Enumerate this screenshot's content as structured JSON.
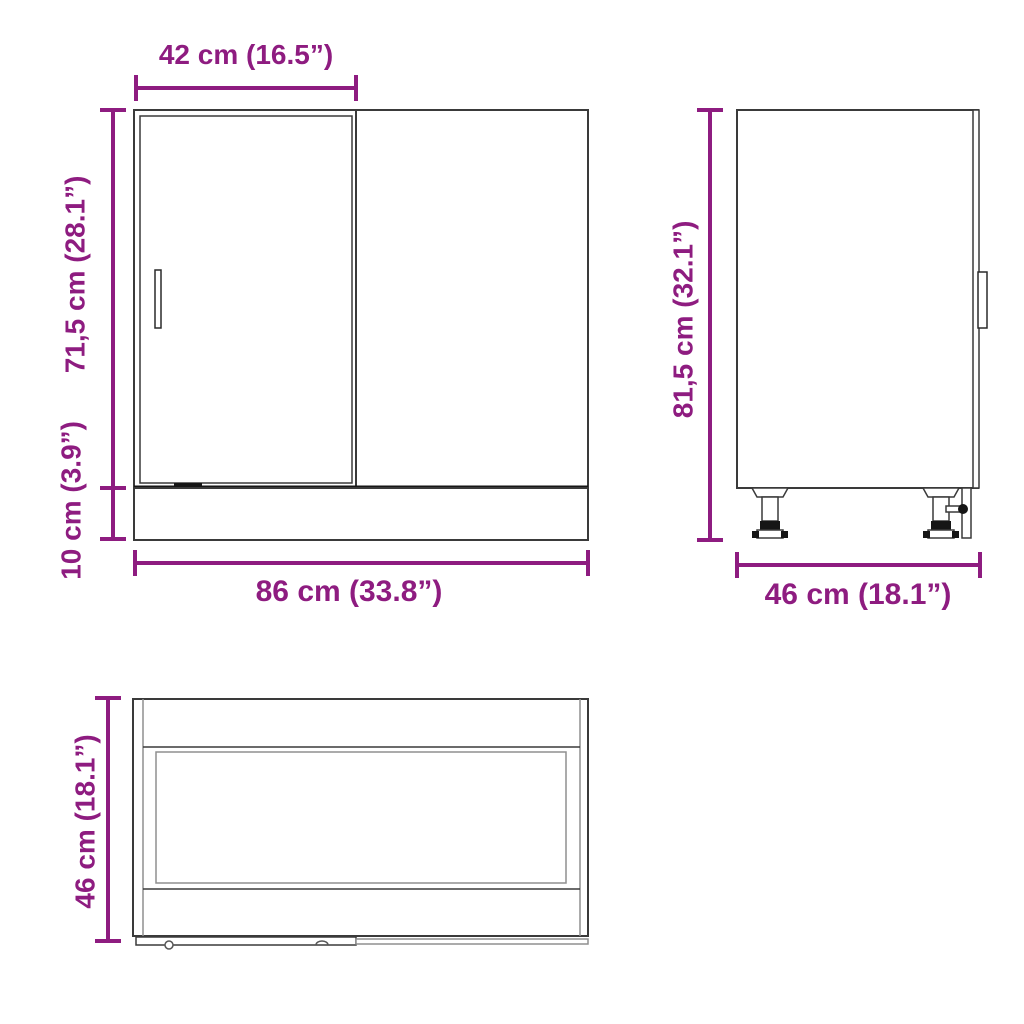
{
  "diagram": {
    "type": "furniture-dimension-diagram",
    "product": "corner base cabinet",
    "views": [
      {
        "id": "front",
        "name": "front view"
      },
      {
        "id": "side",
        "name": "side view"
      },
      {
        "id": "top",
        "name": "bottom/plan view"
      }
    ]
  },
  "dimensions": {
    "door_width": "42 cm (16.5”)",
    "body_height": "71,5 cm (28.1”)",
    "plinth_height": "10 cm (3.9”)",
    "total_width": "86 cm (33.8”)",
    "total_height": "81,5 cm (32.1”)",
    "depth_side": "46 cm (18.1”)",
    "depth_top": "46 cm (18.1”)"
  },
  "colors": {
    "accent": "#8e1c80",
    "line_main": "#3a3a3a",
    "line_dark": "#161616",
    "line_light": "#8f8f8f",
    "background": "#ffffff"
  }
}
